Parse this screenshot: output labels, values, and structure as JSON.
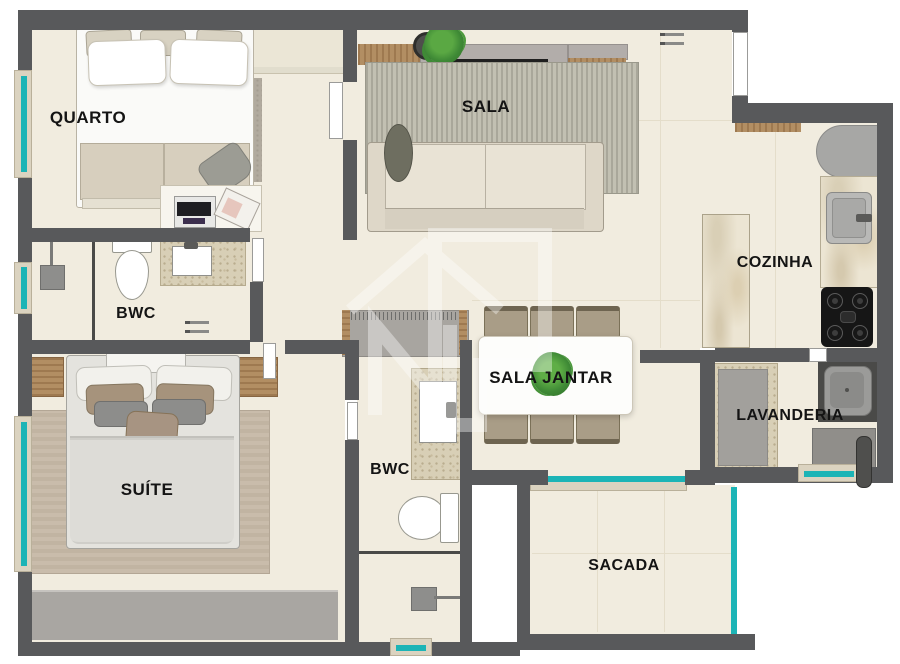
{
  "title": "Planta baixa de apartamento",
  "rooms": {
    "quarto": {
      "label": "QUARTO"
    },
    "sala": {
      "label": "SALA"
    },
    "cozinha": {
      "label": "COZINHA"
    },
    "sala_jantar": {
      "label": "SALA JANTAR"
    },
    "bwc_social": {
      "label": "BWC"
    },
    "suite": {
      "label": "SUÍTE"
    },
    "bwc_suite": {
      "label": "BWC"
    },
    "lavanderia": {
      "label": "LAVANDERIA"
    },
    "sacada": {
      "label": "SACADA"
    }
  },
  "watermark": {
    "icon": "house-n-logo"
  },
  "colors": {
    "wall": "#58595b",
    "floor": "#f1ecdf",
    "window_glass": "#1cb4b6",
    "plant_green": "#4f9a3b",
    "wood": "#b28e63",
    "marble_counter": "#ece5d3",
    "furniture_gray": "#a9a6a2",
    "stove_black": "#161616",
    "label_text": "#141414"
  }
}
